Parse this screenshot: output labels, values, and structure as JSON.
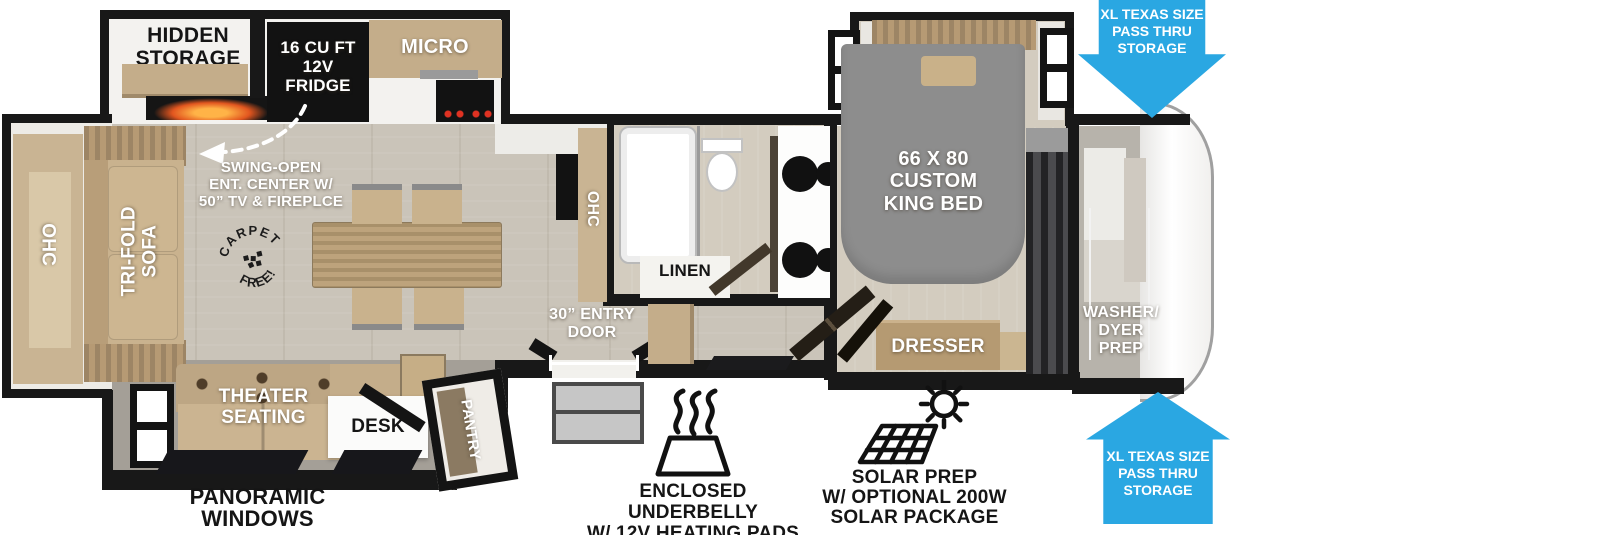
{
  "labels": {
    "hidden_storage": [
      "HIDDEN",
      "STORAGE"
    ],
    "fridge": [
      "16 CU FT",
      "12V",
      "FRIDGE"
    ],
    "micro": "MICRO",
    "swing_open": [
      "SWING-OPEN",
      "ENT. CENTER W/",
      "50” TV & FIREPLCE"
    ],
    "ohc_sofa": "OHC",
    "trifold_sofa": [
      "TRI-FOLD",
      "SOFA"
    ],
    "carpet_stamp": {
      "top": "CARPET",
      "bottom": "FREE!"
    },
    "ohc_kitchen": "OHC",
    "linen": "LINEN",
    "entry_door": [
      "30” ENTRY",
      "DOOR"
    ],
    "king_bed": [
      "66 X 80",
      "CUSTOM",
      "KING BED"
    ],
    "dresser": "DRESSER",
    "washer_prep": [
      "WASHER/",
      "DYER",
      "PREP"
    ],
    "theater_seating": [
      "THEATER",
      "SEATING"
    ],
    "desk": "DESK",
    "pantry": "PANTRY",
    "panoramic_windows": [
      "PANORAMIC",
      "WINDOWS"
    ]
  },
  "callouts": {
    "pass_thru_top": [
      "XL TEXAS SIZE",
      "PASS THRU",
      "STORAGE"
    ],
    "pass_thru_bottom": [
      "XL TEXAS SIZE",
      "PASS THRU",
      "STORAGE"
    ],
    "underbelly": [
      "ENCLOSED UNDERBELLY",
      "W/ 12V HEATING PADS"
    ],
    "solar": [
      "SOLAR PREP",
      "W/ OPTIONAL 200W",
      "SOLAR PACKAGE"
    ]
  },
  "icons": {
    "pass_thru_arrow_top": "blue-down-arrow",
    "pass_thru_arrow_bottom": "blue-up-arrow",
    "underbelly_icon": "heat-waves-over-pad",
    "solar_icon": "solar-panel-with-sun",
    "carpet_free_stamp": "circular-stamp",
    "swing_open_arrow": "dashed-curved-arrow"
  },
  "colors": {
    "arrow_blue": "#2aa7e2",
    "wall_black": "#181818",
    "floor_main": "#cac4b9",
    "floor_slide": "#a49f97",
    "furniture_tan": "#c4ad8a",
    "table_wood": "#b79d74",
    "bed_gray": "#8d8d8d",
    "fire_orange": "#ffb347"
  }
}
